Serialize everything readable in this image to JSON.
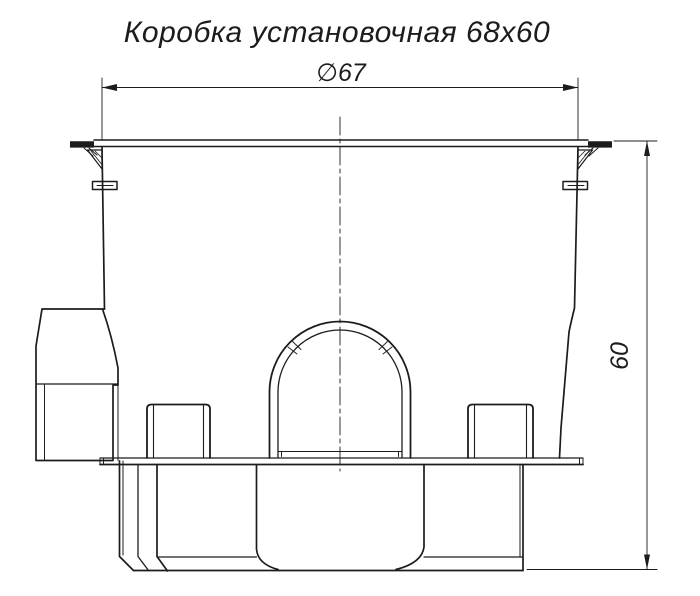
{
  "title": {
    "text": "Коробка установочная 68х60"
  },
  "dimensions": {
    "diameter_label": "∅67",
    "height_label": "60"
  },
  "colors": {
    "line": "#1c1c1c",
    "background": "#ffffff"
  }
}
